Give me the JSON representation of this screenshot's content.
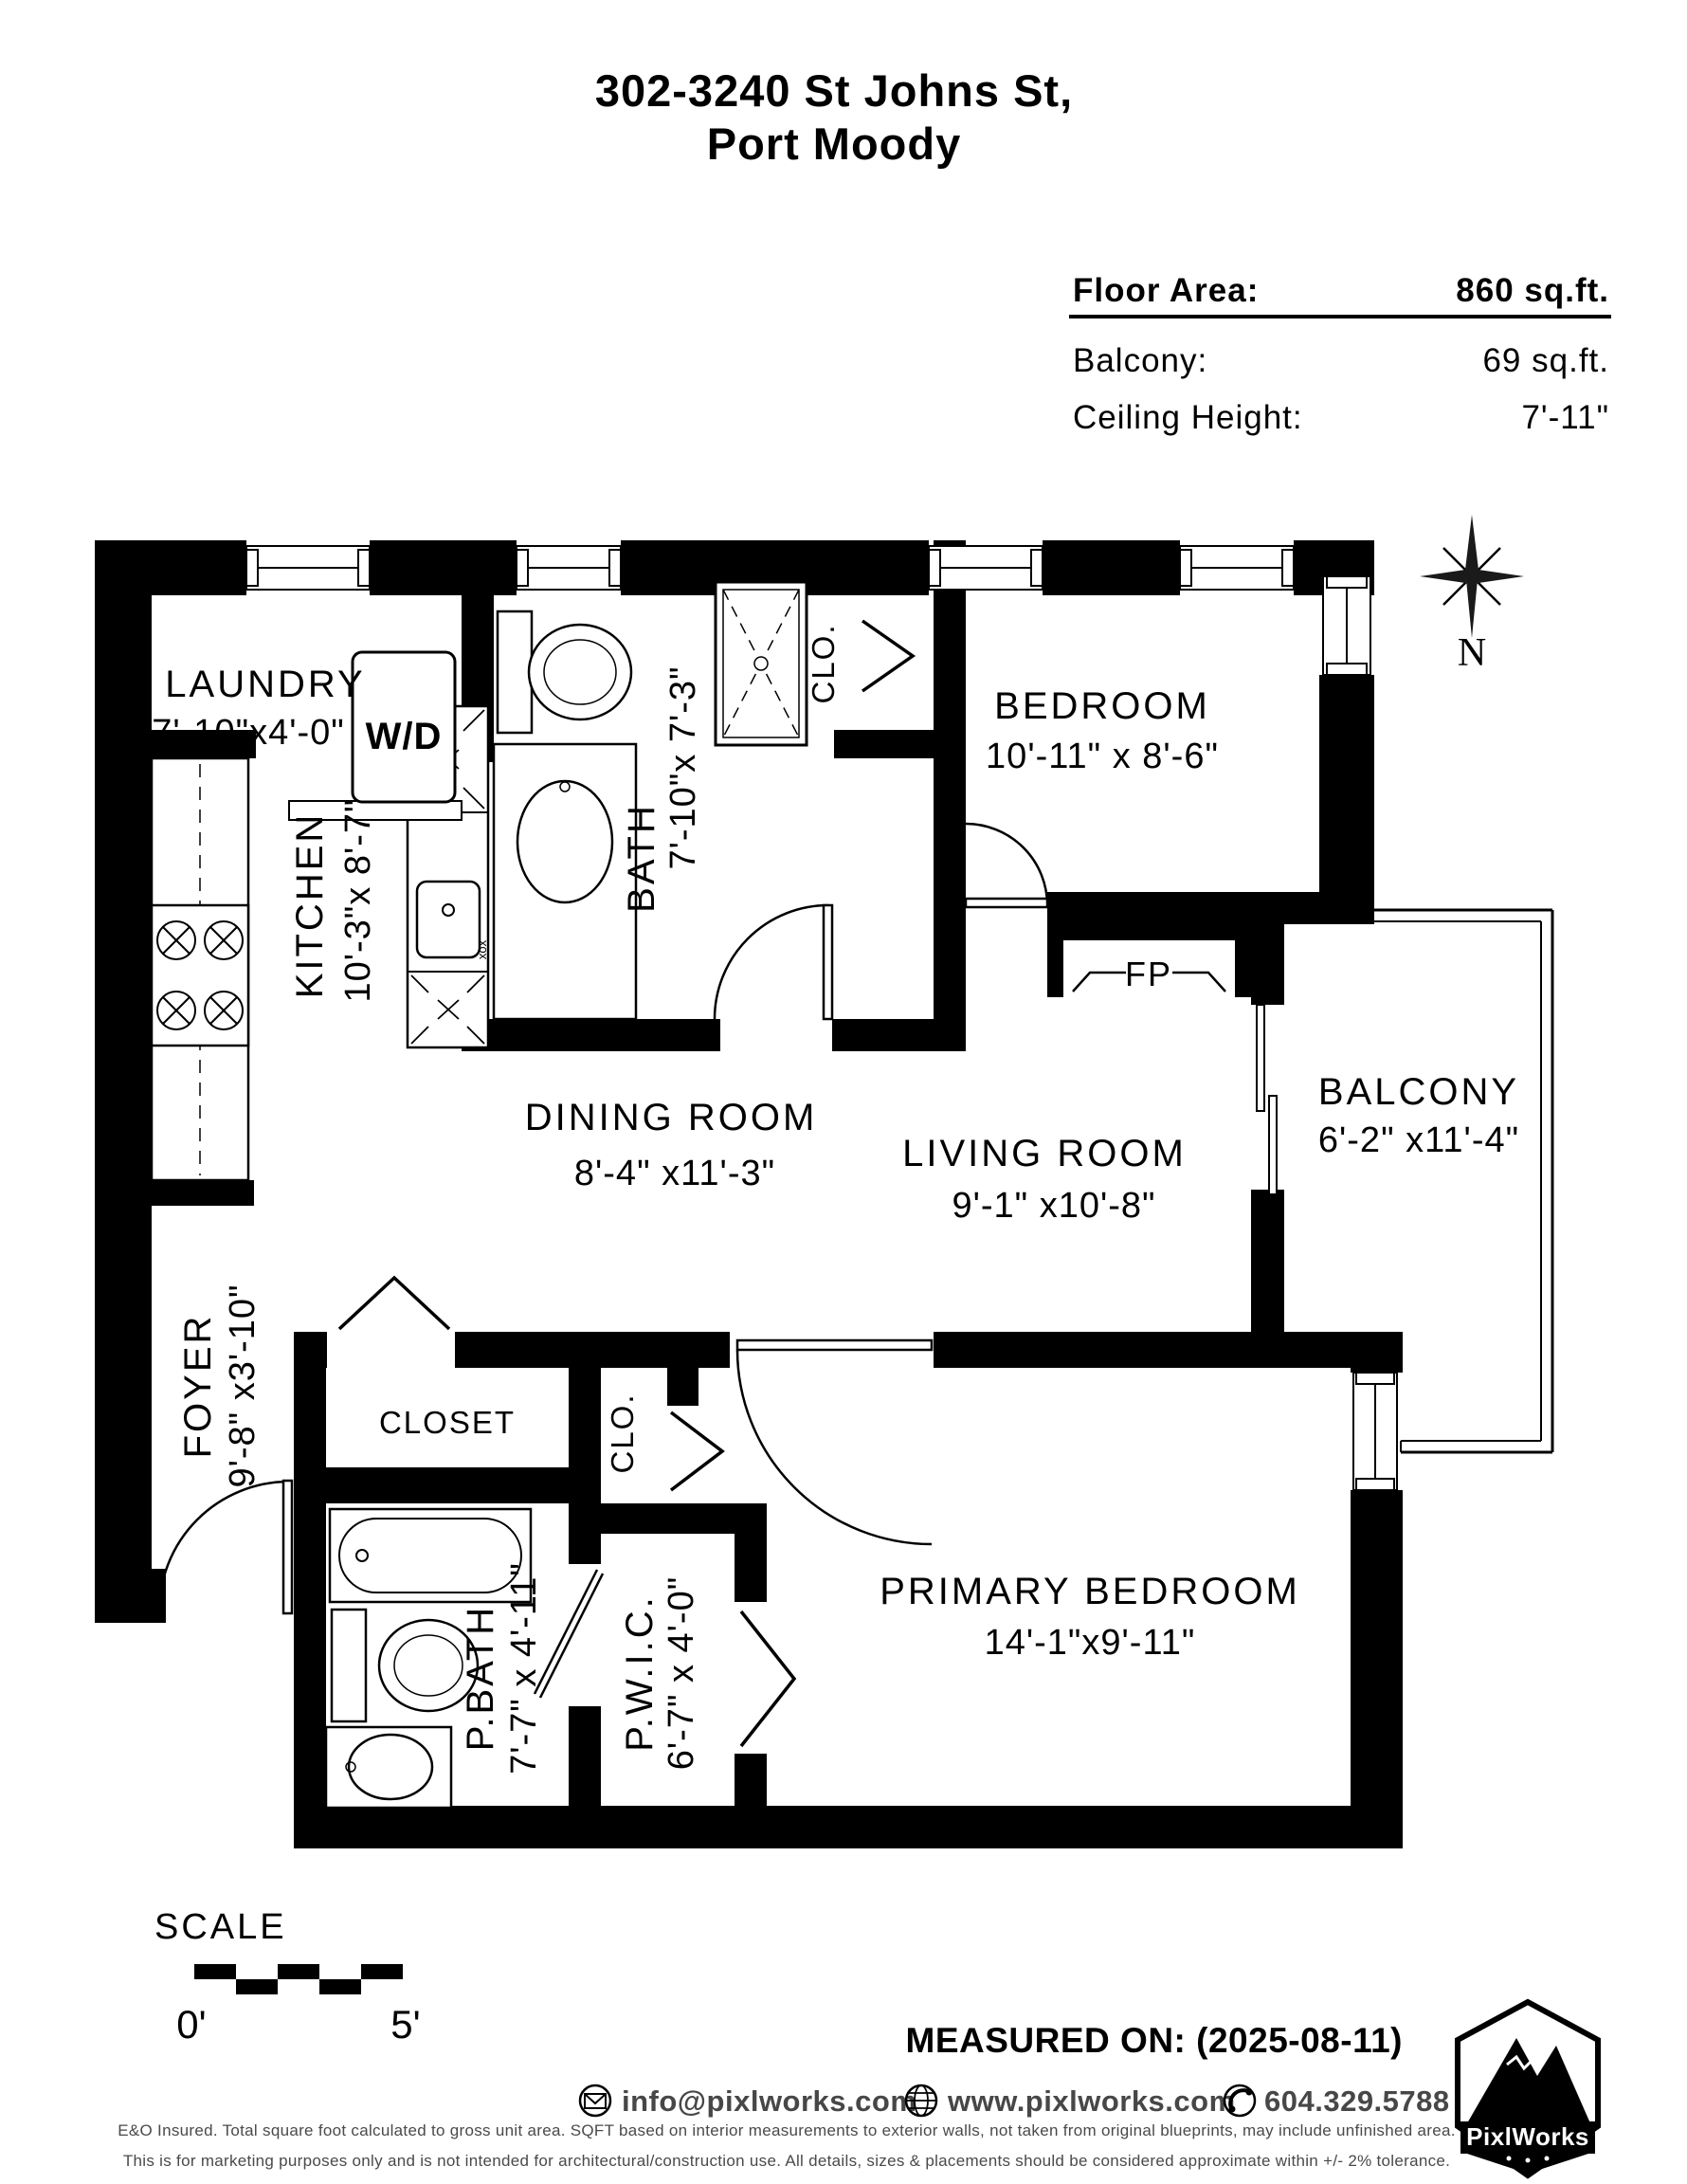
{
  "header": {
    "title_line1": "302-3240 St Johns St,",
    "title_line2": "Port Moody"
  },
  "info": {
    "floor_area_label": "Floor Area:",
    "floor_area_value": "860 sq.ft.",
    "balcony_label": "Balcony:",
    "balcony_value": "69 sq.ft.",
    "ceiling_label": "Ceiling Height:",
    "ceiling_value": "7'-11\""
  },
  "compass": {
    "north": "N"
  },
  "rooms": {
    "laundry": {
      "name": "LAUNDRY",
      "dims": "7'-10\"x4'-0\""
    },
    "bath": {
      "name": "BATH",
      "dims": "7'-10\"x 7'-3\""
    },
    "clo_top": {
      "name": "CLO."
    },
    "bedroom": {
      "name": "BEDROOM",
      "dims": "10'-11\" x 8'-6\""
    },
    "kitchen": {
      "name": "KITCHEN",
      "dims": "10'-3\"x 8'-7\""
    },
    "dining": {
      "name": "DINING ROOM",
      "dims": "8'-4\" x11'-3\""
    },
    "living": {
      "name": "LIVING ROOM",
      "dims": "9'-1\" x10'-8\""
    },
    "balcony": {
      "name": "BALCONY",
      "dims": "6'-2\" x11'-4\""
    },
    "foyer": {
      "name": "FOYER",
      "dims": "9'-8\" x3'-10\""
    },
    "closet": {
      "name": "CLOSET"
    },
    "clo_mid": {
      "name": "CLO."
    },
    "pbath": {
      "name": "P.BATH",
      "dims": "7'-7\" x 4'-11\""
    },
    "pwic": {
      "name": "P.W.I.C.",
      "dims": "6'-7\" x 4'-0\""
    },
    "primary": {
      "name": "PRIMARY BEDROOM",
      "dims": "14'-1\"x9'-11\""
    }
  },
  "fixtures": {
    "washer_dryer": "W/D",
    "fireplace": "FP",
    "faucet_marks": "xox"
  },
  "scale_bar": {
    "label": "SCALE",
    "min": "0'",
    "max": "5'"
  },
  "footer": {
    "measured_on": "MEASURED ON: (2025-08-11)",
    "email": "info@pixlworks.com",
    "website": "www.pixlworks.com",
    "phone": "604.329.5788",
    "logo_text": "PixlWorks",
    "disclaimer1": "E&O Insured.  Total square foot calculated to gross unit area. SQFT based on interior measurements to exterior walls, not taken from original blueprints, may include unfinished area.",
    "disclaimer2": "This is for marketing purposes only and is not intended for architectural/construction use.  All details, sizes & placements should be considered approximate within +/- 2%  tolerance."
  }
}
